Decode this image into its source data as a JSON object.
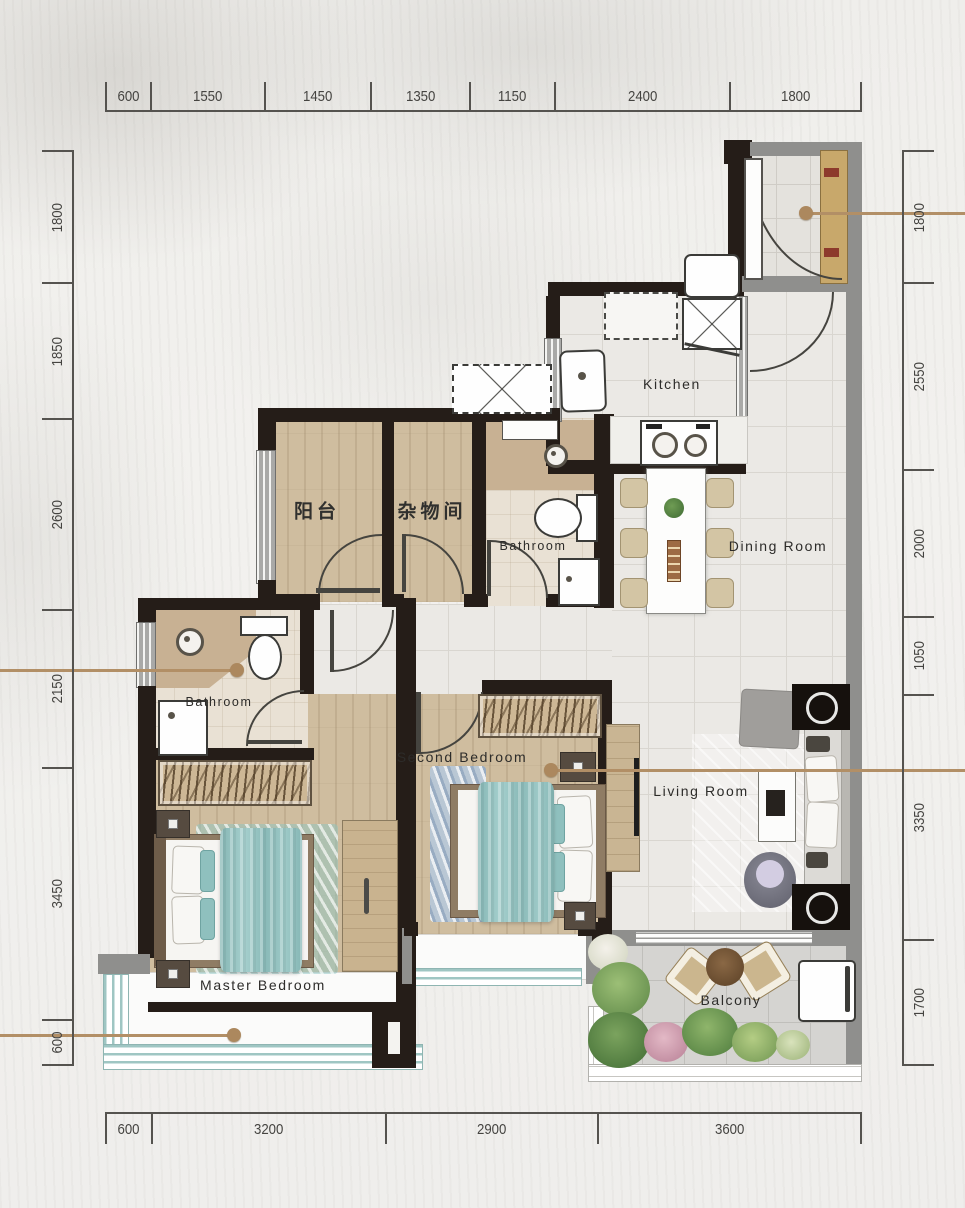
{
  "title": "apartment-floor-plan",
  "dimensions": {
    "top": [
      "600",
      "1550",
      "1450",
      "1350",
      "1150",
      "2400",
      "1800"
    ],
    "bottom": [
      "600",
      "3200",
      "2900",
      "3600"
    ],
    "left": [
      "1800",
      "1850",
      "2600",
      "2150",
      "3450",
      "600"
    ],
    "right": [
      "1800",
      "2550",
      "2000",
      "1050",
      "3350",
      "1700"
    ]
  },
  "rooms": {
    "terrace": "阳台",
    "storage": "杂物间",
    "bath_upper": "Bathroom",
    "bath_master": "Bathroom",
    "kitchen": "Kitchen",
    "dining": "Dining Room",
    "living": "Living Room",
    "second_bedroom": "Second Bedroom",
    "master_bedroom": "Master Bedroom",
    "balcony": "Balcony"
  },
  "colors": {
    "wall": "#251d18",
    "wall_gray": "#8f8f8d",
    "wood_floor": "#cfbd9f",
    "tile_floor": "#ebe9e5",
    "bath_floor": "#e9e1d4",
    "vanity_tan": "#c8b193",
    "blanket_teal": "#93c2c0",
    "window_teal": "#9fc6c3",
    "leader_line": "#b28f66",
    "dimension_text": "#454441",
    "entry_door": "#c8a86b"
  }
}
